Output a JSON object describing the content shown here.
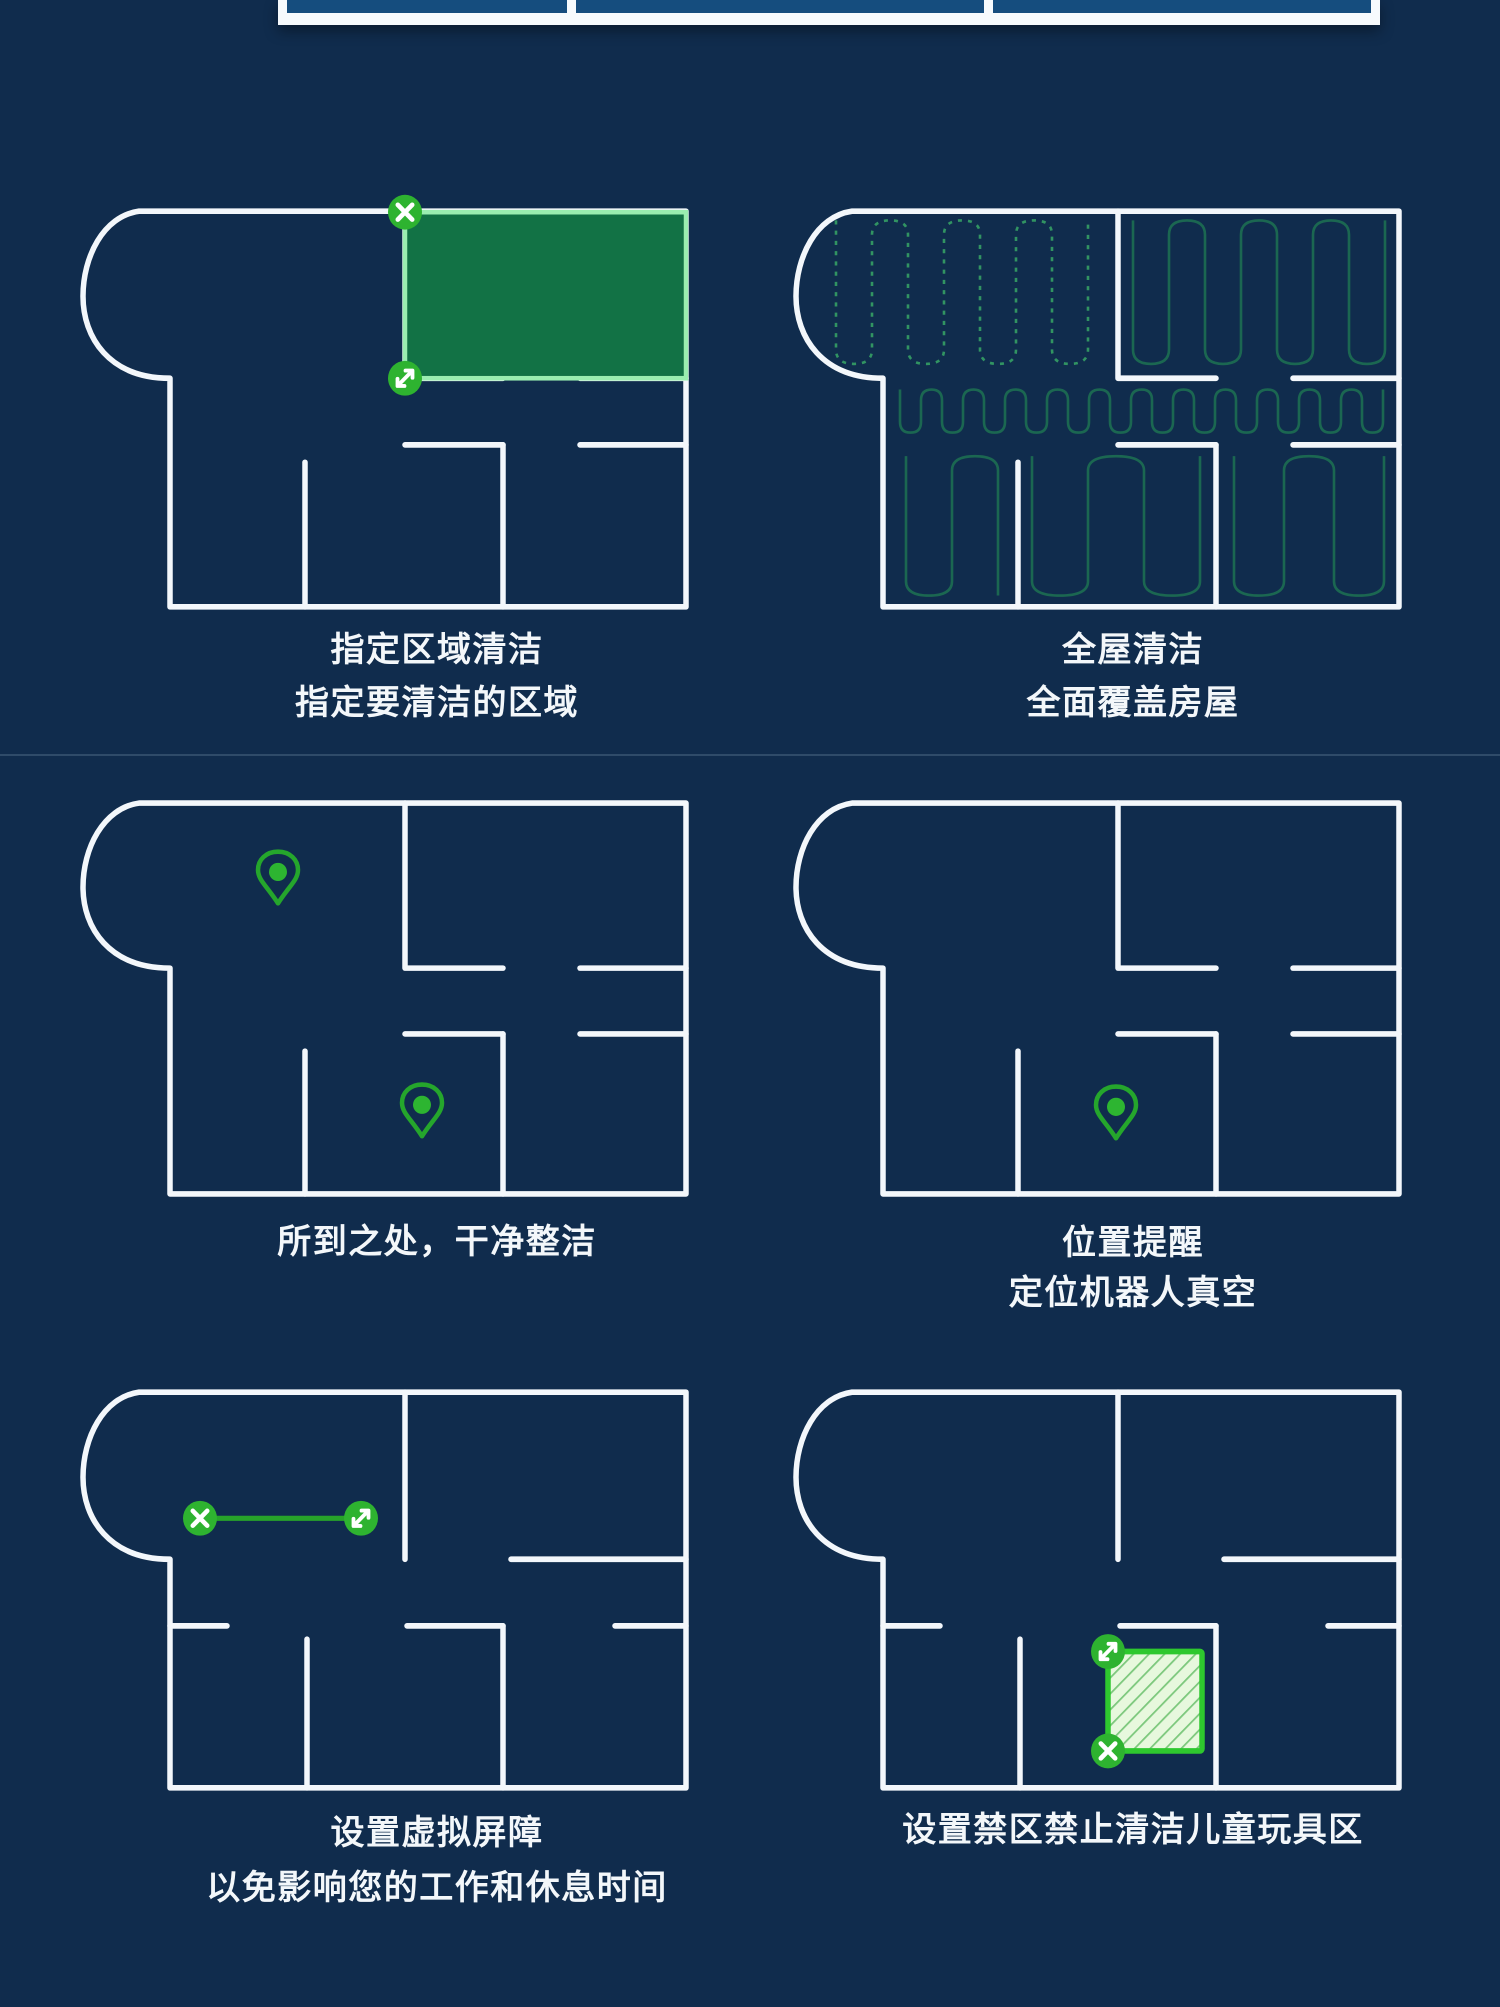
{
  "page": {
    "background": "#102c4d",
    "section_divider_y": 755,
    "description_language": "zh-CN"
  },
  "colors": {
    "wall_white": "#f3f7fb",
    "marker_green": "#2eb330",
    "pin_green": "#25a62c",
    "pin_dot_green": "#2db531",
    "zone_fill": "#127245",
    "zone_border": "#9aeeb0",
    "serpentine_teal": "#1d6e52",
    "serpentine_dashed_green": "#35a065",
    "virtual_wall_green": "#27a32a",
    "nogo_border": "#2ec82e",
    "nogo_fill": "#e7f8dd",
    "nogo_hatch": "#7cc87c",
    "top_cell_fill": "#154d7e"
  },
  "top_strip": {
    "cell_count": 3,
    "note": "bottom edge of previous product graphic"
  },
  "features": [
    {
      "id": "zone-cleaning",
      "caption_lines": [
        "指定区域清洁",
        "指定要清洁的区域"
      ],
      "overlay": "selected-zone-rectangle",
      "marker_icons": [
        "close-marker-icon",
        "resize-marker-icon"
      ]
    },
    {
      "id": "whole-house-cleaning",
      "caption_lines": [
        "全屋清洁",
        "全面覆盖房屋"
      ],
      "overlay": "serpentine-cleaning-paths"
    },
    {
      "id": "clean-everywhere",
      "caption_lines": [
        "所到之处，干净整洁"
      ],
      "overlay": "two-location-pins",
      "marker_icons": [
        "location-pin-icon",
        "location-pin-icon"
      ]
    },
    {
      "id": "location-alert",
      "caption_lines": [
        "位置提醒",
        "定位机器人真空"
      ],
      "overlay": "one-location-pin",
      "marker_icons": [
        "location-pin-icon"
      ]
    },
    {
      "id": "virtual-barrier",
      "caption_lines": [
        "设置虚拟屏障",
        "以免影响您的工作和休息时间"
      ],
      "overlay": "virtual-wall-line",
      "marker_icons": [
        "close-marker-icon",
        "resize-marker-icon"
      ]
    },
    {
      "id": "no-go-zone",
      "caption_lines": [
        "设置禁区禁止清洁儿童玩具区"
      ],
      "overlay": "no-go-hatched-square",
      "marker_icons": [
        "resize-marker-icon",
        "close-marker-icon"
      ]
    }
  ]
}
